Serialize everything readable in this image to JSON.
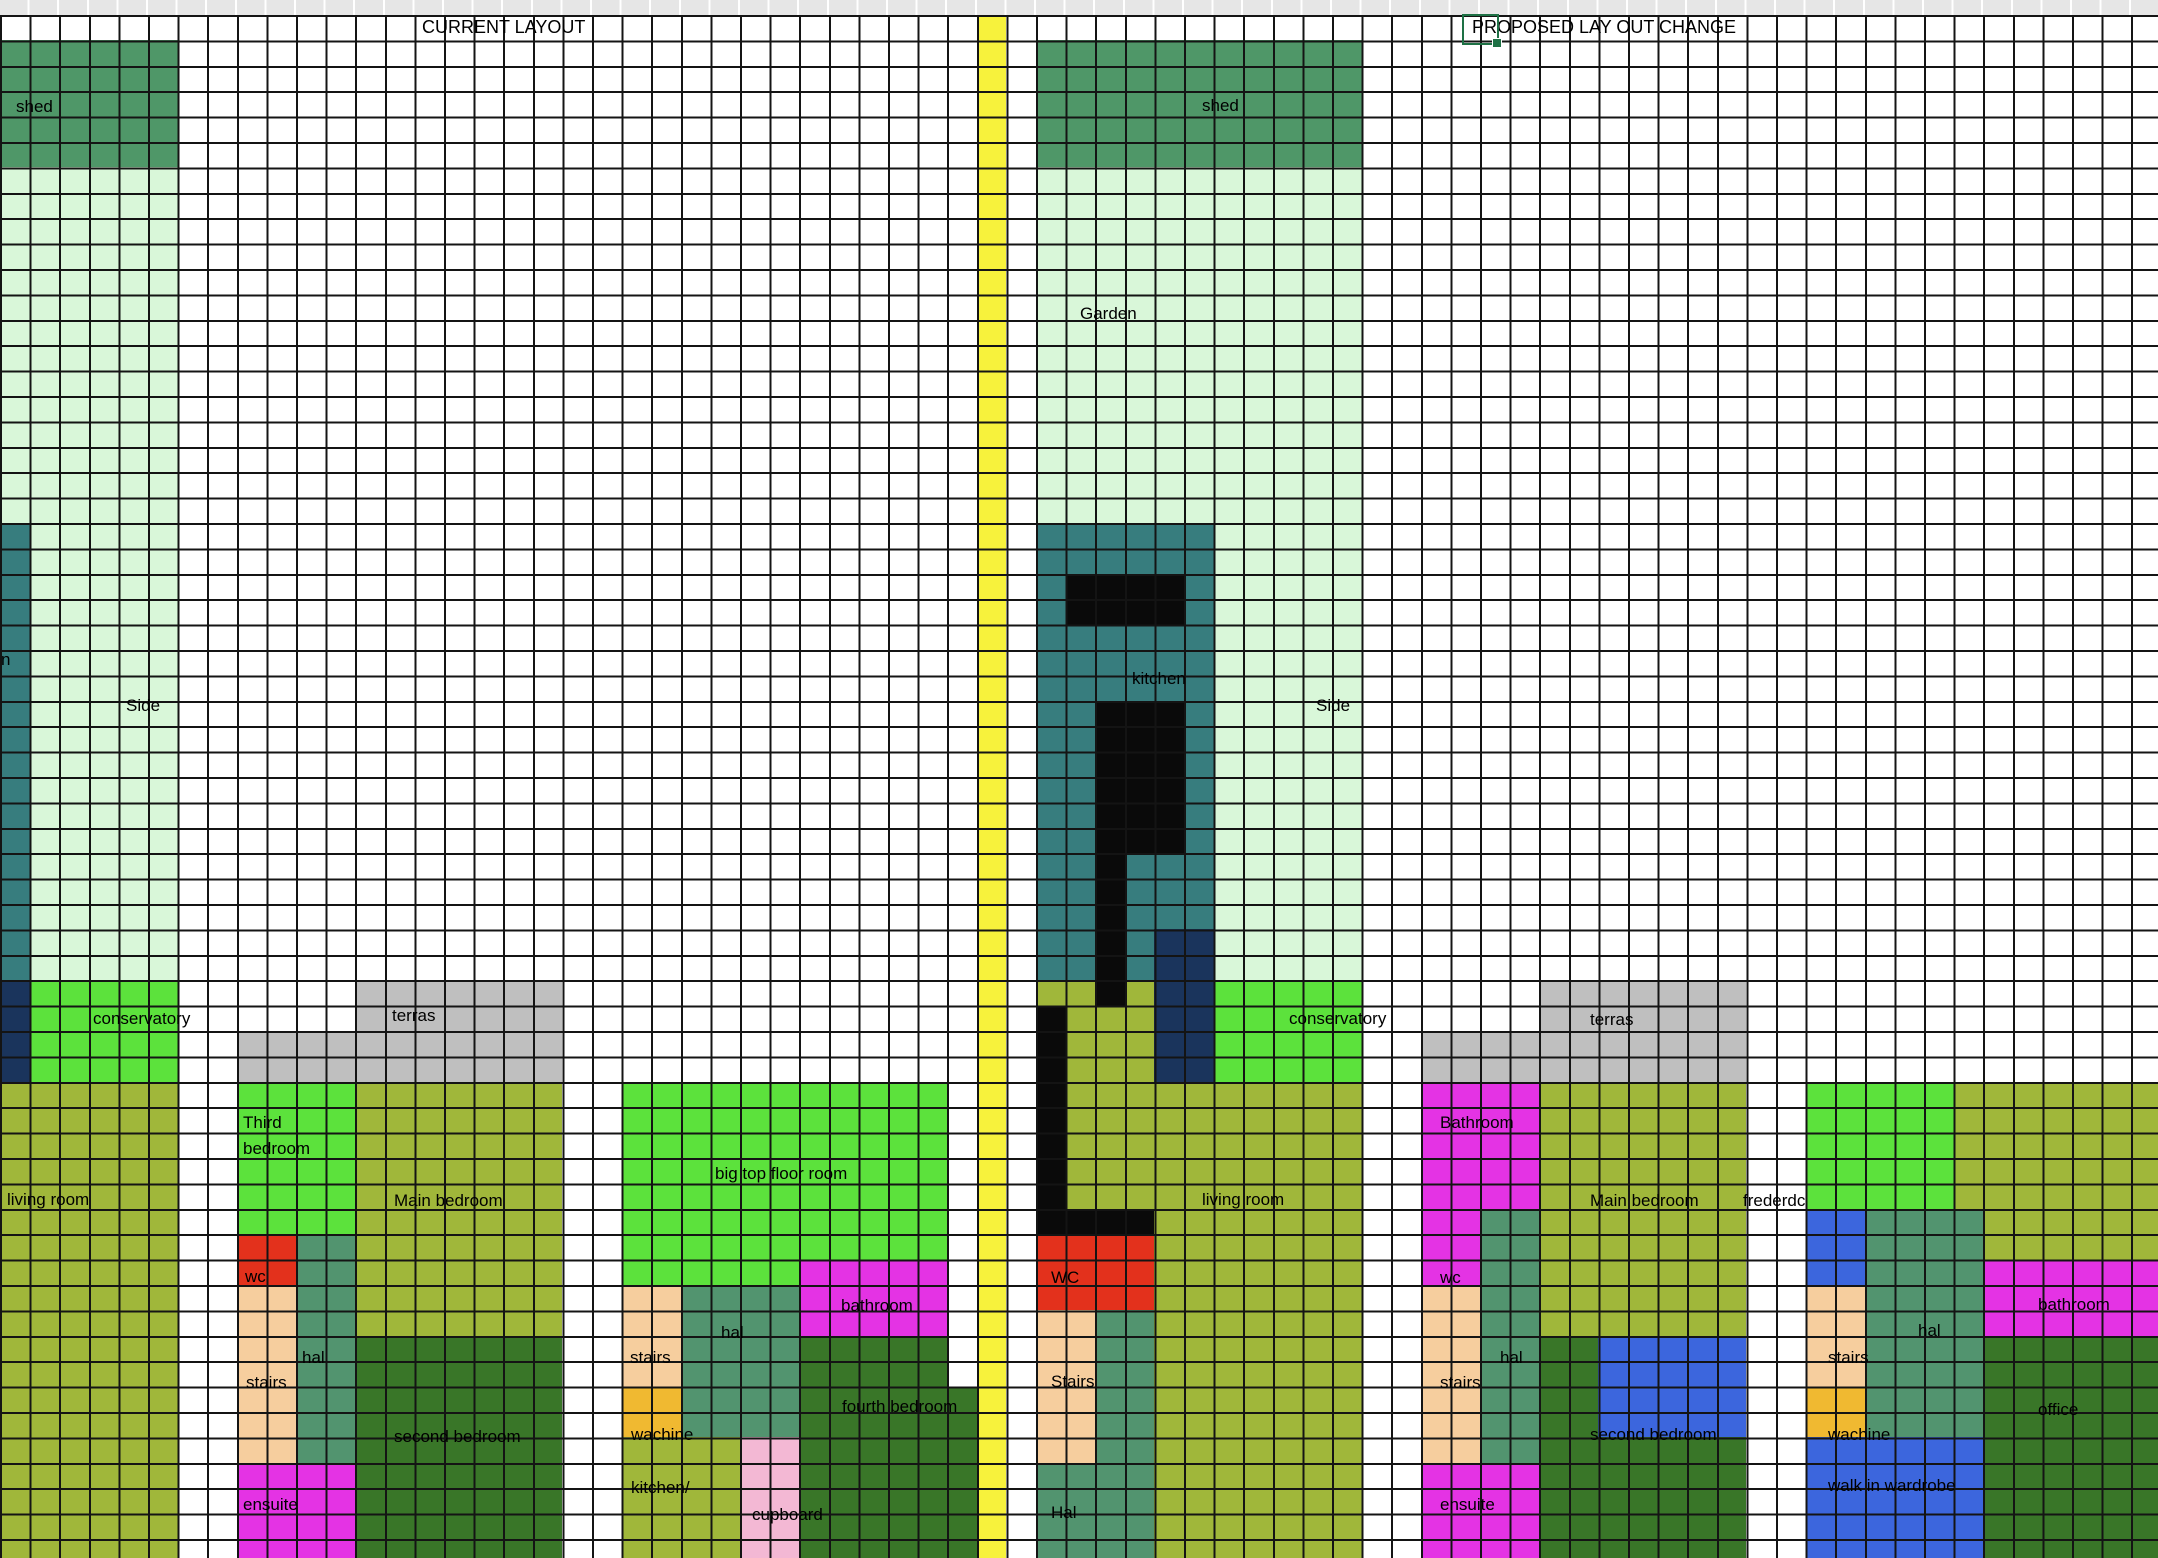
{
  "sheet": {
    "width": 2158,
    "height": 1558,
    "grid": {
      "cell_w": 29.6,
      "row_h": 25.4,
      "top_offset": 15,
      "cols": 73,
      "rows": 61,
      "line_color": "#141414",
      "line_width": 2,
      "header_strip_color": "#e6e6e6"
    },
    "colors": {
      "yellow": "#f7f23c",
      "shed_green": "#4f9768",
      "light_green": "#d9f7d9",
      "teal": "#377d7e",
      "navy": "#1a345c",
      "bright_green": "#5ce23c",
      "gray": "#bfbfbf",
      "olive": "#a0b73a",
      "red": "#e3311c",
      "tan": "#f6ce9e",
      "sea_green": "#52946f",
      "magenta": "#e433e4",
      "dark_green": "#397628",
      "gold": "#f0b931",
      "pink": "#f3b8d4",
      "royal_blue": "#3c66dd",
      "black": "#0a0a0a",
      "selection_green": "#1e7145"
    },
    "titles": {
      "current": "CURRENT LAYOUT",
      "proposed": "PROPOSED LAY OUT CHANGE"
    },
    "selection": {
      "x": 1462,
      "y": 14,
      "w": 33,
      "h": 27
    },
    "regions": [
      {
        "n": "yellow-divider-column",
        "c": 33,
        "r": 0,
        "w": 1,
        "h": 61,
        "col": "yellow"
      },
      {
        "n": "shed-left",
        "c": 0,
        "r": 1,
        "w": 6,
        "h": 5,
        "col": "shed_green"
      },
      {
        "n": "garden-left-strip",
        "c": 0,
        "r": 6,
        "w": 6,
        "h": 32,
        "col": "light_green"
      },
      {
        "n": "kitchen-left-edge-strip",
        "c": 0,
        "r": 20,
        "w": 1,
        "h": 18,
        "col": "teal"
      },
      {
        "n": "navy-left",
        "c": 0,
        "r": 38,
        "w": 1,
        "h": 4,
        "col": "navy"
      },
      {
        "n": "conservatory-left",
        "c": 1,
        "r": 38,
        "w": 5,
        "h": 4,
        "col": "bright_green"
      },
      {
        "n": "terras-left-upper",
        "c": 12,
        "r": 38,
        "w": 7,
        "h": 2,
        "col": "gray"
      },
      {
        "n": "terras-left-lower",
        "c": 8,
        "r": 40,
        "w": 11,
        "h": 2,
        "col": "gray"
      },
      {
        "n": "shed-mid",
        "c": 35,
        "r": 1,
        "w": 11,
        "h": 5,
        "col": "shed_green"
      },
      {
        "n": "garden-mid",
        "c": 35,
        "r": 6,
        "w": 11,
        "h": 32,
        "col": "light_green"
      },
      {
        "n": "kitchen-proposed",
        "c": 35,
        "r": 20,
        "w": 6,
        "h": 18,
        "col": "teal"
      },
      {
        "n": "navy-mid",
        "c": 39,
        "r": 36,
        "w": 2,
        "h": 6,
        "col": "navy"
      },
      {
        "n": "olive-under-kitchen-a",
        "c": 35,
        "r": 38,
        "w": 1,
        "h": 1,
        "col": "olive"
      },
      {
        "n": "olive-under-kitchen-b",
        "c": 36,
        "r": 38,
        "w": 3,
        "h": 4,
        "col": "olive"
      },
      {
        "n": "conservatory-right",
        "c": 41,
        "r": 38,
        "w": 5,
        "h": 4,
        "col": "bright_green"
      },
      {
        "n": "terras-right-upper",
        "c": 52,
        "r": 38,
        "w": 7,
        "h": 2,
        "col": "gray"
      },
      {
        "n": "terras-right-lower",
        "c": 48,
        "r": 40,
        "w": 11,
        "h": 2,
        "col": "gray"
      },
      {
        "n": "living-room-left",
        "c": 0,
        "r": 42,
        "w": 6,
        "h": 19,
        "col": "olive"
      },
      {
        "n": "third-bedroom",
        "c": 8,
        "r": 42,
        "w": 4,
        "h": 6,
        "col": "bright_green"
      },
      {
        "n": "wc-left",
        "c": 8,
        "r": 48,
        "w": 2,
        "h": 2,
        "col": "red"
      },
      {
        "n": "hal-left",
        "c": 10,
        "r": 48,
        "w": 2,
        "h": 9,
        "col": "sea_green"
      },
      {
        "n": "stairs-left",
        "c": 8,
        "r": 50,
        "w": 2,
        "h": 7,
        "col": "tan"
      },
      {
        "n": "ensuite-left",
        "c": 8,
        "r": 57,
        "w": 4,
        "h": 4,
        "col": "magenta"
      },
      {
        "n": "main-bedroom-left",
        "c": 12,
        "r": 42,
        "w": 7,
        "h": 10,
        "col": "olive"
      },
      {
        "n": "second-bedroom-left",
        "c": 12,
        "r": 52,
        "w": 7,
        "h": 9,
        "col": "dark_green"
      },
      {
        "n": "big-top-floor-room-a",
        "c": 21,
        "r": 42,
        "w": 11,
        "h": 7,
        "col": "bright_green"
      },
      {
        "n": "big-top-floor-room-b",
        "c": 21,
        "r": 49,
        "w": 6,
        "h": 1,
        "col": "bright_green"
      },
      {
        "n": "bathroom-mid",
        "c": 27,
        "r": 49,
        "w": 5,
        "h": 3,
        "col": "magenta"
      },
      {
        "n": "stairs-mid",
        "c": 21,
        "r": 50,
        "w": 2,
        "h": 4,
        "col": "tan"
      },
      {
        "n": "wachine-mid",
        "c": 21,
        "r": 54,
        "w": 2,
        "h": 2,
        "col": "gold"
      },
      {
        "n": "hal-mid",
        "c": 23,
        "r": 50,
        "w": 4,
        "h": 6,
        "col": "sea_green"
      },
      {
        "n": "kitchen-cupboard-olive",
        "c": 21,
        "r": 56,
        "w": 4,
        "h": 5,
        "col": "olive"
      },
      {
        "n": "cupboard-pink",
        "c": 25,
        "r": 56,
        "w": 2,
        "h": 5,
        "col": "pink"
      },
      {
        "n": "fourth-bedroom",
        "c": 27,
        "r": 52,
        "w": 5,
        "h": 9,
        "col": "dark_green"
      },
      {
        "n": "fourth-bedroom-ext",
        "c": 32,
        "r": 54,
        "w": 1,
        "h": 7,
        "col": "dark_green"
      },
      {
        "n": "living-room-right-a",
        "c": 36,
        "r": 42,
        "w": 10,
        "h": 6,
        "col": "olive"
      },
      {
        "n": "living-room-right-b",
        "c": 39,
        "r": 48,
        "w": 7,
        "h": 13,
        "col": "olive"
      },
      {
        "n": "wc-proposed",
        "c": 35,
        "r": 48,
        "w": 4,
        "h": 3,
        "col": "red"
      },
      {
        "n": "stairs-proposed",
        "c": 35,
        "r": 51,
        "w": 2,
        "h": 6,
        "col": "tan"
      },
      {
        "n": "hal-strip-proposed",
        "c": 37,
        "r": 51,
        "w": 2,
        "h": 6,
        "col": "sea_green"
      },
      {
        "n": "hal-proposed",
        "c": 35,
        "r": 57,
        "w": 4,
        "h": 4,
        "col": "sea_green"
      },
      {
        "n": "bathroom-right-a",
        "c": 48,
        "r": 42,
        "w": 4,
        "h": 5,
        "col": "magenta"
      },
      {
        "n": "bathroom-right-b",
        "c": 48,
        "r": 47,
        "w": 2,
        "h": 3,
        "col": "magenta"
      },
      {
        "n": "hal-right",
        "c": 50,
        "r": 47,
        "w": 2,
        "h": 10,
        "col": "sea_green"
      },
      {
        "n": "stairs-right",
        "c": 48,
        "r": 50,
        "w": 2,
        "h": 7,
        "col": "tan"
      },
      {
        "n": "ensuite-right",
        "c": 48,
        "r": 57,
        "w": 4,
        "h": 4,
        "col": "magenta"
      },
      {
        "n": "main-bedroom-right",
        "c": 52,
        "r": 42,
        "w": 7,
        "h": 10,
        "col": "olive"
      },
      {
        "n": "second-bedroom-right",
        "c": 52,
        "r": 52,
        "w": 7,
        "h": 9,
        "col": "dark_green"
      },
      {
        "n": "second-bedroom-blue",
        "c": 54,
        "r": 52,
        "w": 5,
        "h": 4,
        "col": "royal_blue"
      },
      {
        "n": "far-right-green",
        "c": 61,
        "r": 42,
        "w": 5,
        "h": 5,
        "col": "bright_green"
      },
      {
        "n": "far-right-olive-a",
        "c": 66,
        "r": 42,
        "w": 7,
        "h": 5,
        "col": "olive"
      },
      {
        "n": "far-right-olive-b",
        "c": 67,
        "r": 47,
        "w": 6,
        "h": 2,
        "col": "olive"
      },
      {
        "n": "far-right-blue-top",
        "c": 61,
        "r": 47,
        "w": 2,
        "h": 3,
        "col": "royal_blue"
      },
      {
        "n": "hal-far-right",
        "c": 63,
        "r": 47,
        "w": 4,
        "h": 9,
        "col": "sea_green"
      },
      {
        "n": "bathroom-far-right",
        "c": 67,
        "r": 49,
        "w": 6,
        "h": 3,
        "col": "magenta"
      },
      {
        "n": "stairs-far-right",
        "c": 61,
        "r": 50,
        "w": 2,
        "h": 4,
        "col": "tan"
      },
      {
        "n": "wachine-far-right",
        "c": 61,
        "r": 54,
        "w": 2,
        "h": 2,
        "col": "gold"
      },
      {
        "n": "office",
        "c": 67,
        "r": 52,
        "w": 6,
        "h": 9,
        "col": "dark_green"
      },
      {
        "n": "walk-in-wardrobe",
        "c": 61,
        "r": 56,
        "w": 6,
        "h": 5,
        "col": "royal_blue"
      },
      {
        "n": "kitchen-black-counter-top",
        "c": 36,
        "r": 22,
        "w": 4,
        "h": 2,
        "col": "black"
      },
      {
        "n": "kitchen-black-island",
        "c": 37,
        "r": 27,
        "w": 3,
        "h": 6,
        "col": "black"
      },
      {
        "n": "kitchen-black-column",
        "c": 37,
        "r": 33,
        "w": 1,
        "h": 6,
        "col": "black"
      },
      {
        "n": "black-wall-vertical",
        "c": 35,
        "r": 39,
        "w": 1,
        "h": 8,
        "col": "black"
      },
      {
        "n": "black-wall-bar",
        "c": 35,
        "r": 47,
        "w": 4,
        "h": 1,
        "col": "black"
      }
    ],
    "labels": [
      {
        "n": "title-current-layout",
        "t": "CURRENT LAYOUT",
        "x": 422,
        "y": 27,
        "size": 18
      },
      {
        "n": "title-proposed-layout",
        "t": "PROPOSED LAY OUT CHANGE",
        "x": 1472,
        "y": 27,
        "size": 18
      },
      {
        "n": "label-shed-left",
        "t": "shed",
        "x": 16,
        "y": 107
      },
      {
        "n": "label-shed-mid",
        "t": "shed",
        "x": 1202,
        "y": 106
      },
      {
        "n": "label-garden",
        "t": "Garden",
        "x": 1080,
        "y": 314
      },
      {
        "n": "label-kitchen-cut",
        "t": "n",
        "x": 1,
        "y": 660
      },
      {
        "n": "label-side-left",
        "t": "Side",
        "x": 126,
        "y": 706
      },
      {
        "n": "label-kitchen",
        "t": "kitchen",
        "x": 1132,
        "y": 679
      },
      {
        "n": "label-side-right",
        "t": "Side",
        "x": 1316,
        "y": 706
      },
      {
        "n": "label-conservatory-left",
        "t": "conservatory",
        "x": 93,
        "y": 1019
      },
      {
        "n": "label-terras-left",
        "t": "terras",
        "x": 392,
        "y": 1016
      },
      {
        "n": "label-conservatory-right",
        "t": "conservatory",
        "x": 1289,
        "y": 1019
      },
      {
        "n": "label-terras-right",
        "t": "terras",
        "x": 1590,
        "y": 1020
      },
      {
        "n": "label-third",
        "t": "Third",
        "x": 243,
        "y": 1123
      },
      {
        "n": "label-third-bedroom",
        "t": "bedroom",
        "x": 243,
        "y": 1149
      },
      {
        "n": "label-bathroom-right",
        "t": "Bathroom",
        "x": 1440,
        "y": 1123
      },
      {
        "n": "label-big-top-floor-room",
        "t": "big top floor room",
        "x": 715,
        "y": 1174
      },
      {
        "n": "label-living-room-left",
        "t": "living room",
        "x": 7,
        "y": 1200
      },
      {
        "n": "label-main-bedroom-left",
        "t": "Main bedroom",
        "x": 394,
        "y": 1201
      },
      {
        "n": "label-living-room-right",
        "t": "living room",
        "x": 1202,
        "y": 1200
      },
      {
        "n": "label-main-bedroom-right",
        "t": "Main bedroom",
        "x": 1590,
        "y": 1201
      },
      {
        "n": "label-frederdc",
        "t": "frederdc",
        "x": 1743,
        "y": 1201
      },
      {
        "n": "label-wc-left",
        "t": "wc",
        "x": 245,
        "y": 1277
      },
      {
        "n": "label-wc-proposed",
        "t": "WC",
        "x": 1051,
        "y": 1278
      },
      {
        "n": "label-wc-right",
        "t": "wc",
        "x": 1440,
        "y": 1278
      },
      {
        "n": "label-bathroom-mid",
        "t": "bathroom",
        "x": 841,
        "y": 1306
      },
      {
        "n": "label-bathroom-far-right",
        "t": "bathroom",
        "x": 2038,
        "y": 1305
      },
      {
        "n": "label-hal-mid",
        "t": "hal",
        "x": 721,
        "y": 1333
      },
      {
        "n": "label-hal-far-right",
        "t": "hal",
        "x": 1918,
        "y": 1331
      },
      {
        "n": "label-hal-left",
        "t": "hal",
        "x": 302,
        "y": 1358
      },
      {
        "n": "label-stairs-mid",
        "t": "stairs",
        "x": 630,
        "y": 1358
      },
      {
        "n": "label-hal-right",
        "t": "hal",
        "x": 1500,
        "y": 1358
      },
      {
        "n": "label-stairs-far-right",
        "t": "stairs",
        "x": 1828,
        "y": 1358
      },
      {
        "n": "label-stairs-left",
        "t": "stairs",
        "x": 246,
        "y": 1383
      },
      {
        "n": "label-stairs-proposed",
        "t": "Stairs",
        "x": 1051,
        "y": 1382
      },
      {
        "n": "label-stairs-right",
        "t": "stairs",
        "x": 1440,
        "y": 1383
      },
      {
        "n": "label-fourth-bedroom",
        "t": "fourth bedroom",
        "x": 842,
        "y": 1407
      },
      {
        "n": "label-office",
        "t": "office",
        "x": 2038,
        "y": 1410
      },
      {
        "n": "label-wachine-mid",
        "t": "wachine",
        "x": 631,
        "y": 1435
      },
      {
        "n": "label-wachine-far-right",
        "t": "wachine",
        "x": 1828,
        "y": 1435
      },
      {
        "n": "label-second-bedroom-left",
        "t": "second bedroom",
        "x": 394,
        "y": 1437
      },
      {
        "n": "label-second-bedroom-right",
        "t": "second bedroom",
        "x": 1590,
        "y": 1435
      },
      {
        "n": "label-kitchen-slash",
        "t": "kitchen/",
        "x": 631,
        "y": 1488
      },
      {
        "n": "label-walk-in-wardrobe",
        "t": "walk in wardrobe",
        "x": 1828,
        "y": 1486
      },
      {
        "n": "label-ensuite-left",
        "t": "ensuite",
        "x": 243,
        "y": 1505
      },
      {
        "n": "label-ensuite-right",
        "t": "ensuite",
        "x": 1440,
        "y": 1505
      },
      {
        "n": "label-hal-proposed",
        "t": "Hal",
        "x": 1051,
        "y": 1513
      },
      {
        "n": "label-cupboard",
        "t": "cupboard",
        "x": 752,
        "y": 1515
      }
    ]
  }
}
